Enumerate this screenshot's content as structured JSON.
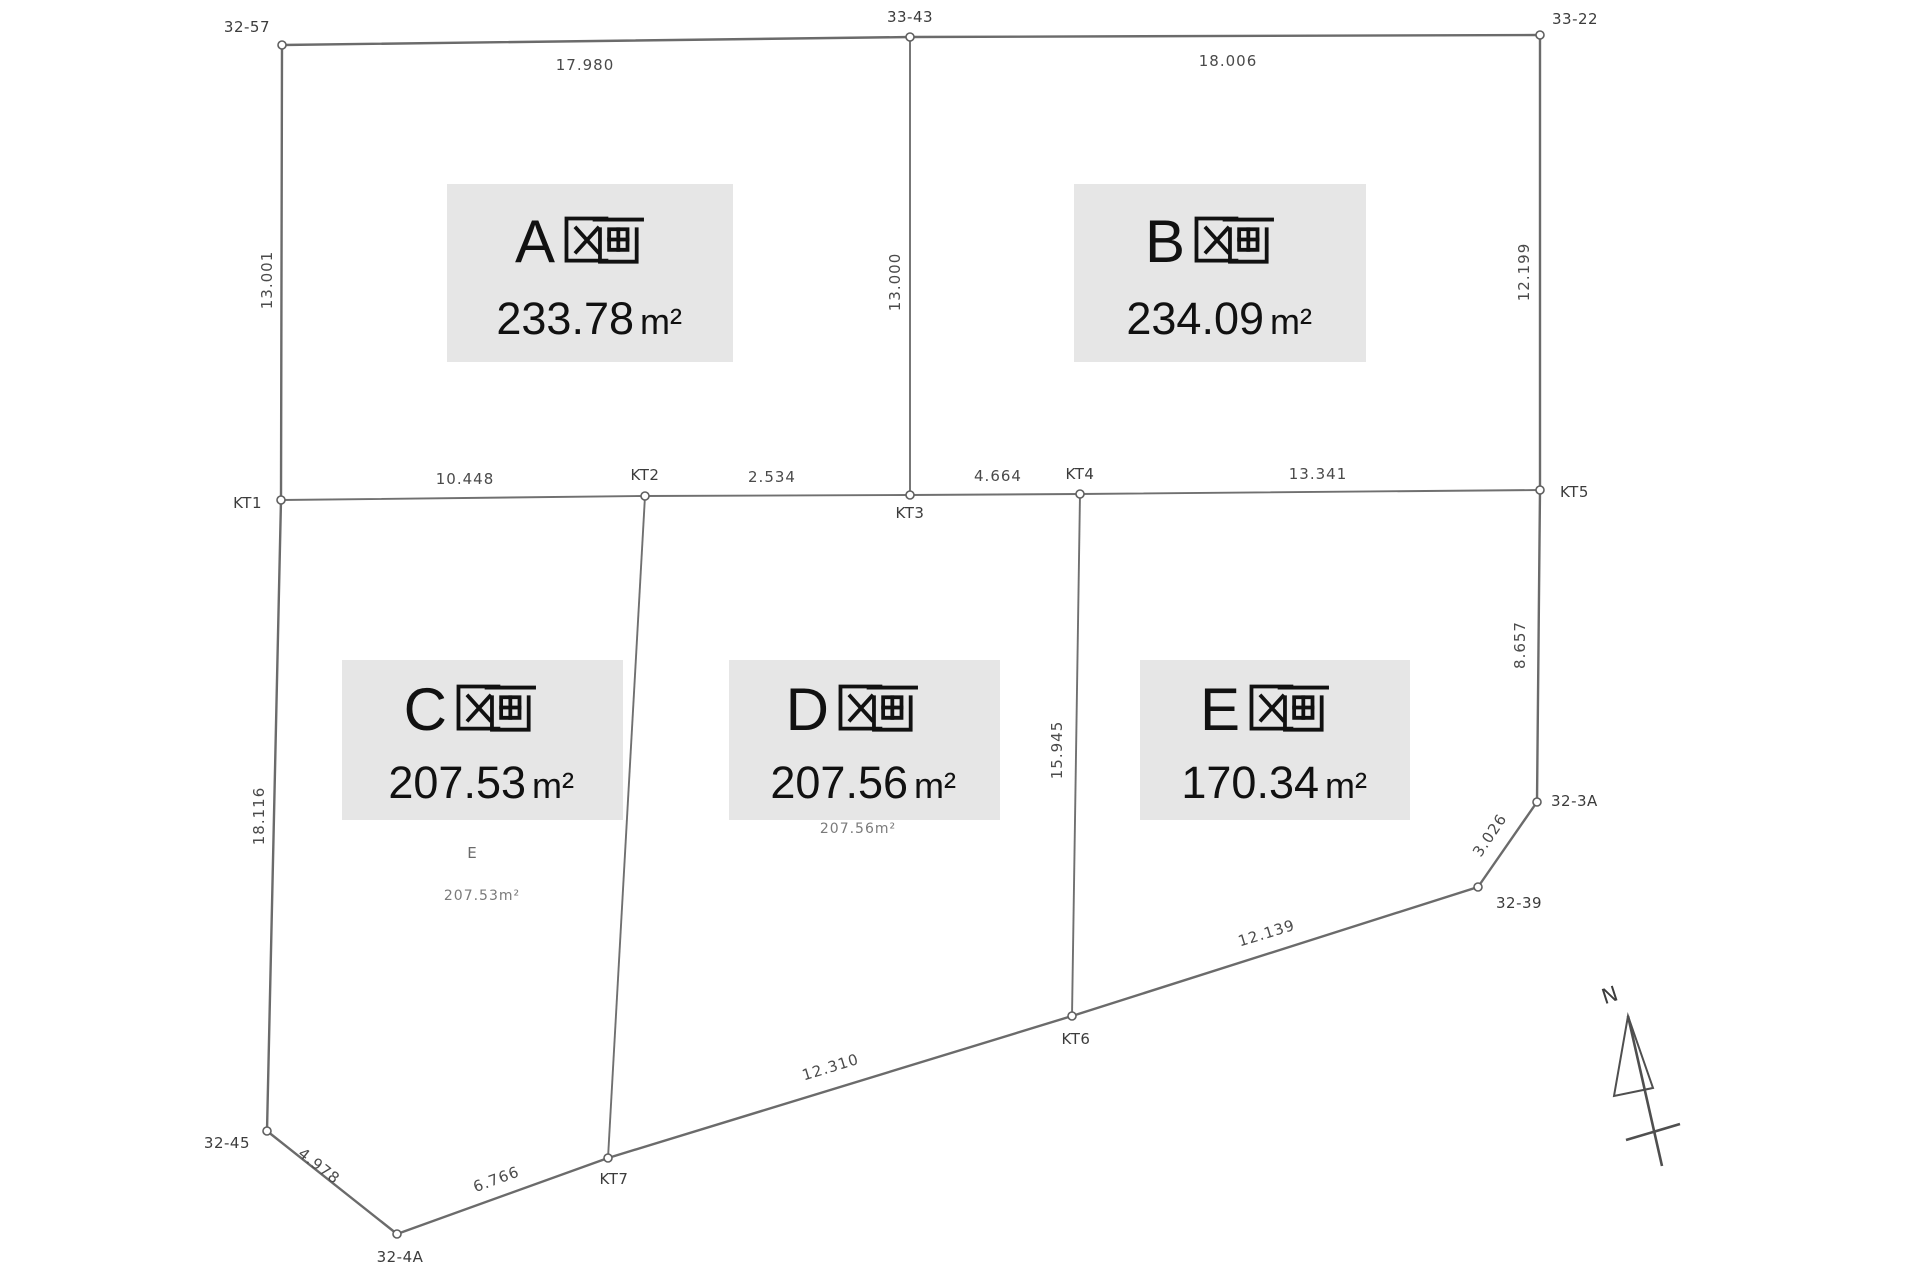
{
  "plots": {
    "a": {
      "name": "A区画",
      "letter": "A",
      "area": "233.78",
      "unit": "m²"
    },
    "b": {
      "name": "B区画",
      "letter": "B",
      "area": "234.09",
      "unit": "m²"
    },
    "c": {
      "name": "C区画",
      "letter": "C",
      "area": "207.53",
      "unit": "m²"
    },
    "d": {
      "name": "D区画",
      "letter": "D",
      "area": "207.56",
      "unit": "m²"
    },
    "e": {
      "name": "E区画",
      "letter": "E",
      "area": "170.34",
      "unit": "m²"
    }
  },
  "points": {
    "p32_57": "32-57",
    "p33_43": "33-43",
    "p33_22": "33-22",
    "kt1": "KT1",
    "kt2": "KT2",
    "kt3": "KT3",
    "kt4": "KT4",
    "kt5": "KT5",
    "kt6": "KT6",
    "kt7": "KT7",
    "p32_45": "32-45",
    "p32_4a": "32-4A",
    "p32_39": "32-39",
    "p32_3a": "32-3A"
  },
  "dimensions": {
    "top_left": "17.980",
    "top_right": "18.006",
    "left_upper": "13.001",
    "center_vertical": "13.000",
    "right_upper": "12.199",
    "kt1_kt2": "10.448",
    "kt2_kt3": "2.534",
    "kt3_kt4": "4.664",
    "kt4_kt5": "13.341",
    "right_lower": "8.657",
    "edge_3a_39": "3.026",
    "edge_39_kt6": "12.139",
    "kt6_kt7": "12.310",
    "kt2_kt7": "18.905",
    "kt4_kt6": "15.945",
    "left_lower": "18.116",
    "kt7_4a": "6.766",
    "p45_4a": "4.978"
  },
  "annotations": {
    "c_mark": "E",
    "c_area_faint": "207.53m²",
    "d_area_faint": "207.56m²"
  },
  "compass": {
    "north_label": "N"
  },
  "colors": {
    "background": "#ffffff",
    "line": "#6b6b6b",
    "label_box_bg": "#e6e6e6",
    "label_text": "#111111",
    "dim_text": "#4a4a4a"
  }
}
